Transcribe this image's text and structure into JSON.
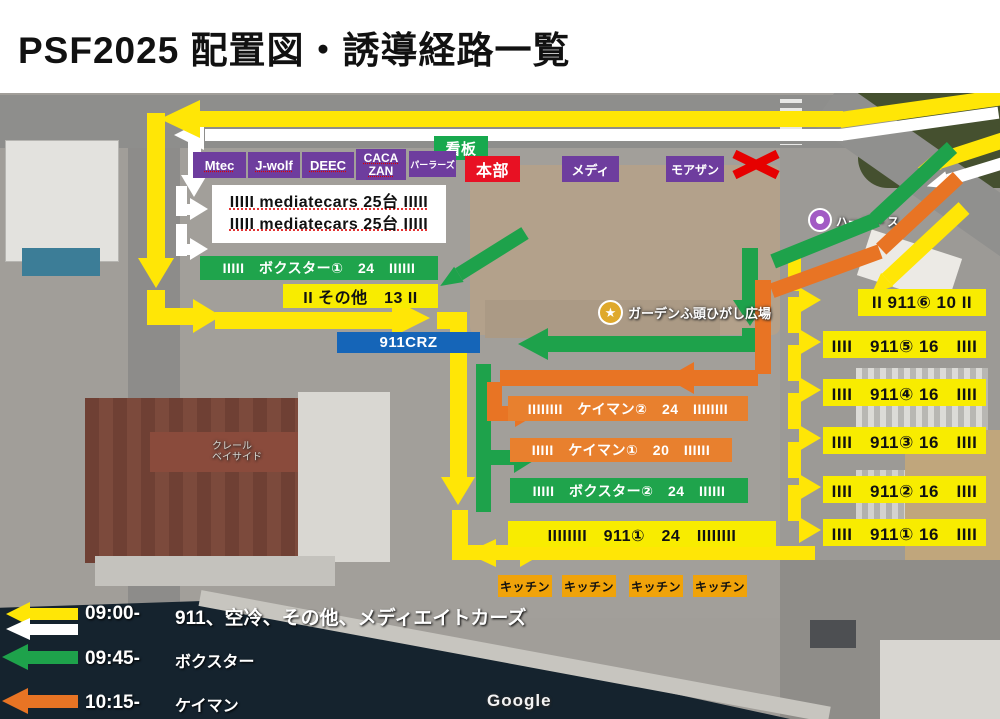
{
  "title": "PSF2025 配置図・誘導経路一覧",
  "top": {
    "sign": "看板",
    "booths": [
      "Mtec",
      "J-wolf",
      "DEEC",
      "CACA ZAN",
      "パーラーズ"
    ],
    "hq": "本部",
    "medi": "メディ",
    "moazan": "モアザン"
  },
  "media_box": {
    "line1": "IIIII mediatecars 25台 IIIII",
    "line2": "IIIII mediatecars 25台 IIIII"
  },
  "zones": {
    "boxster1": "IIIII　ボクスター①　24　IIIIII",
    "sonota": "II その他　13 II",
    "crz": "911CRZ",
    "cayman2": "IIIIIIII　ケイマン②　24　IIIIIIII",
    "cayman1": "IIIII　ケイマン①　20　IIIIII",
    "boxster2": "IIIII　ボクスター②　24　IIIIII",
    "p911_1": "IIIIIIII　911①　24　IIIIIIII"
  },
  "zones_right": [
    "II 911⑥ 10 II",
    "IIII　911⑤ 16　IIII",
    "IIII　911④ 16　IIII",
    "IIII　911③ 16　IIII",
    "IIII　911② 16　IIII",
    "IIII　911① 16　IIII"
  ],
  "kitchens": [
    "キッチン",
    "キッチン",
    "キッチン",
    "キッチン"
  ],
  "poi": {
    "garden": "ガーデンふ頭ひがし広場",
    "harbor": "ハーバー ス",
    "building1": "クレール",
    "building2": "ベイサイド"
  },
  "legend": [
    {
      "time": "09:00-",
      "label": "911、空冷、その他、メディエイトカーズ"
    },
    {
      "time": "09:45-",
      "label": "ボクスター"
    },
    {
      "time": "10:15-",
      "label": "ケイマン"
    }
  ],
  "watermark": "Google",
  "colors": {
    "route_yellow": "#ffe606",
    "route_white": "#ffffff",
    "route_green": "#1ea24b",
    "route_orange": "#e87424",
    "zone_yellow": "#f8ec00",
    "zone_green": "#1fa44c",
    "zone_orange": "#e8802e",
    "booth_purple": "#6e3d9e",
    "hq_red": "#e81123",
    "crz_blue": "#1565b8",
    "kitchen_amber": "#f0a30a"
  }
}
